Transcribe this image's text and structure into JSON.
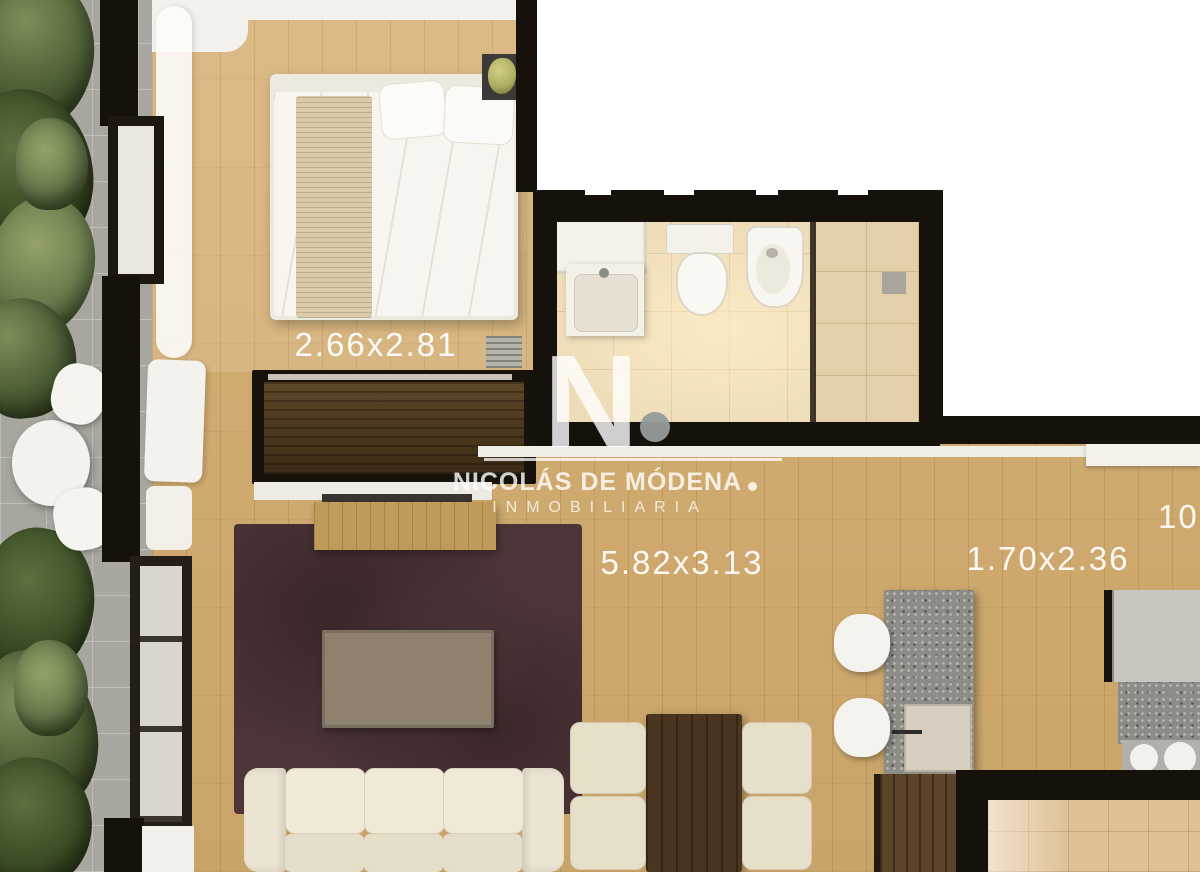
{
  "watermark": {
    "monogram": "N",
    "name": "NICOLÁS DE MÓDENA",
    "tagline": "INMOBILIARIA"
  },
  "dimensions": {
    "bedroom": "2.66x2.81",
    "living_dining": "5.82x3.13",
    "kitchen": "1.70x2.36",
    "right_edge_partial": "10"
  },
  "colors": {
    "wood_floor": "#cfa96d",
    "dark_wall": "#17110c",
    "rug_maroon": "#4e3538",
    "bathroom_tile": "#eedcb9",
    "balcony_tile": "#a8a79f",
    "granite_grey": "#8d8d87",
    "dark_wood": "#533c22",
    "sofa_cream": "#ebe4d2",
    "plant_green": "#54663a",
    "cutout_white": "#ffffff",
    "watermark_white": "rgba(255,255,255,0.8)"
  }
}
